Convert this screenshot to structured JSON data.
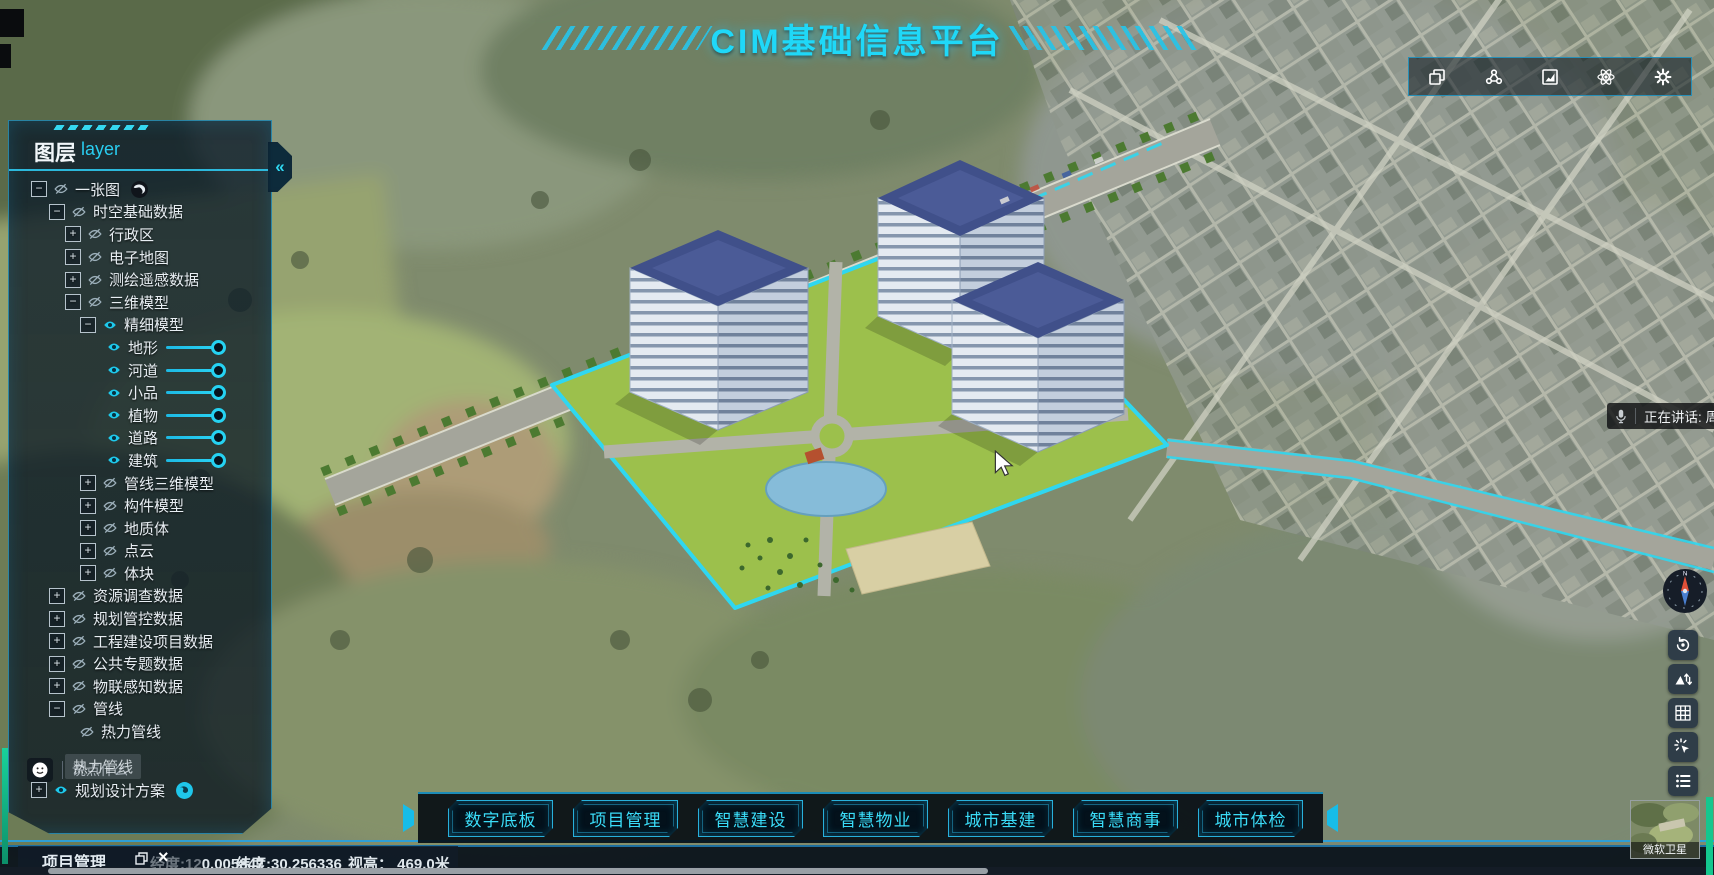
{
  "colors": {
    "accent": "#2fd7f0",
    "panel_border": "#2daad7",
    "nav_text": "#3adcf8",
    "slider": "#25d2f2"
  },
  "title": {
    "text": "CIM基础信息平台"
  },
  "top_toolbar": {
    "icons": [
      "copy-layers-icon",
      "scene-cluster-icon",
      "statistics-chart-icon",
      "atom-effects-icon",
      "settings-gear-icon"
    ]
  },
  "layer_panel": {
    "title_zh": "图层",
    "title_en": "layer",
    "collapse_glyph": "«",
    "toggle_glyphs": {
      "minus": "−",
      "plus": "+"
    },
    "tree": [
      {
        "label": "一张图",
        "level": 0,
        "toggle": "minus",
        "icon": "eye-slash",
        "trailing": "globe-dark"
      },
      {
        "label": "时空基础数据",
        "level": 1,
        "toggle": "minus",
        "icon": "eye-slash"
      },
      {
        "label": "行政区",
        "level": 2,
        "toggle": "plus",
        "icon": "eye-slash"
      },
      {
        "label": "电子地图",
        "level": 2,
        "toggle": "plus",
        "icon": "eye-slash"
      },
      {
        "label": "测绘遥感数据",
        "level": 2,
        "toggle": "plus",
        "icon": "eye-slash"
      },
      {
        "label": "三维模型",
        "level": 2,
        "toggle": "minus",
        "icon": "eye-slash"
      },
      {
        "label": "精细模型",
        "level": 3,
        "toggle": "minus",
        "icon": "eye-cyan"
      },
      {
        "label": "地形",
        "level": 4,
        "icon": "eye-cyan",
        "slider": true,
        "value": 100
      },
      {
        "label": "河道",
        "level": 4,
        "icon": "eye-cyan",
        "slider": true,
        "value": 100
      },
      {
        "label": "小品",
        "level": 4,
        "icon": "eye-cyan",
        "slider": true,
        "value": 100
      },
      {
        "label": "植物",
        "level": 4,
        "icon": "eye-cyan",
        "slider": true,
        "value": 100
      },
      {
        "label": "道路",
        "level": 4,
        "icon": "eye-cyan",
        "slider": true,
        "value": 100
      },
      {
        "label": "建筑",
        "level": 4,
        "icon": "eye-cyan",
        "slider": true,
        "value": 100
      },
      {
        "label": "管线三维模型",
        "level": 3,
        "toggle": "plus",
        "icon": "eye-slash"
      },
      {
        "label": "构件模型",
        "level": 3,
        "toggle": "plus",
        "icon": "eye-slash"
      },
      {
        "label": "地质体",
        "level": 3,
        "toggle": "plus",
        "icon": "eye-slash"
      },
      {
        "label": "点云",
        "level": 3,
        "toggle": "plus",
        "icon": "eye-slash"
      },
      {
        "label": "体块",
        "level": 3,
        "toggle": "plus",
        "icon": "eye-slash"
      },
      {
        "label": "资源调查数据",
        "level": 1,
        "toggle": "plus",
        "icon": "eye-slash"
      },
      {
        "label": "规划管控数据",
        "level": 1,
        "toggle": "plus",
        "icon": "eye-slash"
      },
      {
        "label": "工程建设项目数据",
        "level": 1,
        "toggle": "plus",
        "icon": "eye-slash"
      },
      {
        "label": "公共专题数据",
        "level": 1,
        "toggle": "plus",
        "icon": "eye-slash"
      },
      {
        "label": "物联感知数据",
        "level": 1,
        "toggle": "plus",
        "icon": "eye-slash"
      },
      {
        "label": "管线",
        "level": 1,
        "toggle": "minus",
        "icon": "eye-slash"
      },
      {
        "label": "热力管线",
        "level": 2,
        "icon": "eye-slash"
      }
    ],
    "chat": {
      "placeholder": "说点什么",
      "ghost": "热力管线"
    },
    "tree_footer": [
      {
        "label": "规划设计方案",
        "level": 0,
        "toggle": "plus",
        "icon": "eye-cyan",
        "trailing": "globe-cyan"
      }
    ]
  },
  "bottom_nav": {
    "items": [
      {
        "name": "digital-base",
        "label": "数字底板"
      },
      {
        "name": "project-management",
        "label": "项目管理"
      },
      {
        "name": "smart-construction",
        "label": "智慧建设"
      },
      {
        "name": "smart-property",
        "label": "智慧物业"
      },
      {
        "name": "city-infrastructure",
        "label": "城市基建"
      },
      {
        "name": "smart-business",
        "label": "智慧商事"
      },
      {
        "name": "city-checkup",
        "label": "城市体检"
      }
    ]
  },
  "project_window": {
    "title": "项目管理",
    "close_glyph": "×"
  },
  "statusbar": {
    "lon_prefix": "经度:12",
    "lon_suffix": "0.005847",
    "lat": "纬度:30.256336",
    "alt": "视高： 469.0米"
  },
  "voice_toast": {
    "text": "正在讲话: 周航"
  },
  "right_toolbar": {
    "compass_north": "N",
    "buttons": [
      "reset-view-icon",
      "terrain-exaggeration-icon",
      "grid-icon",
      "click-effect-icon",
      "legend-list-icon"
    ]
  },
  "minimap": {
    "label": "微软卫星"
  }
}
